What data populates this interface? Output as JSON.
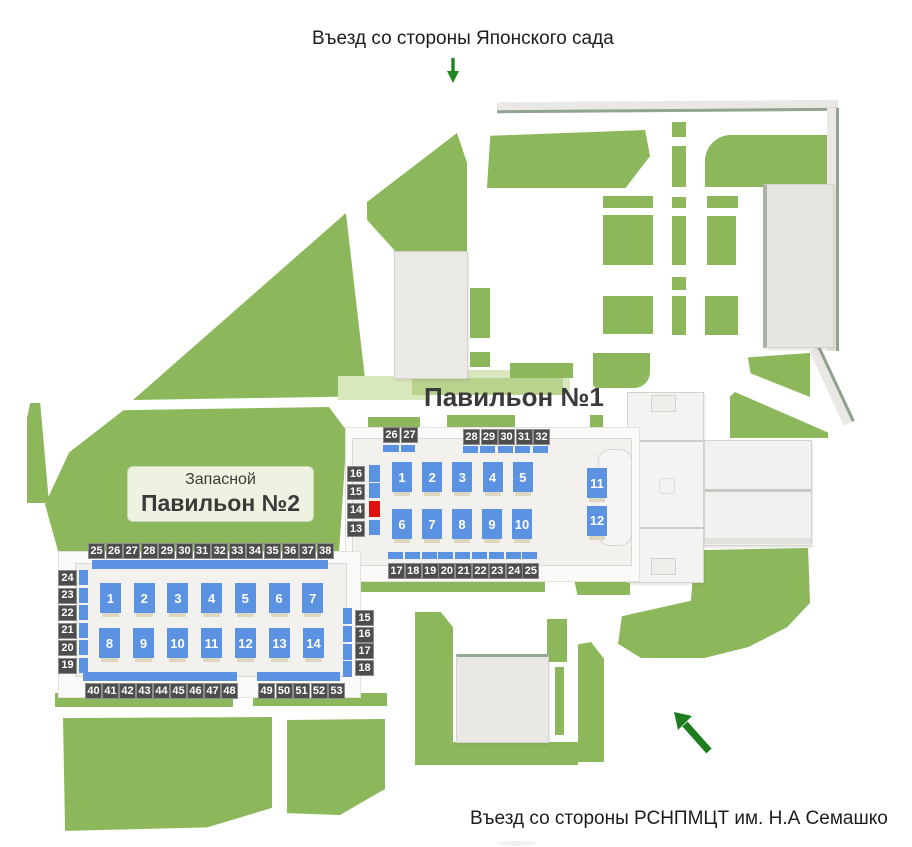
{
  "entrances": {
    "top": {
      "label": "Въезд со стороны Японского сада"
    },
    "bottom": {
      "label": "Въезд со стороны РСНПМЦТ им. Н.А Семашко"
    }
  },
  "pavilion1": {
    "title": "Павильон №1",
    "booths_row1": [
      "1",
      "2",
      "3",
      "4",
      "5"
    ],
    "booths_row2": [
      "6",
      "7",
      "8",
      "9",
      "10"
    ],
    "booths_right": [
      "11",
      "12"
    ],
    "top_badges_left": [
      "26",
      "27"
    ],
    "top_badges_right": [
      "28",
      "29",
      "30",
      "31",
      "32"
    ],
    "left_badges": [
      "16",
      "15",
      "14",
      "13"
    ],
    "bottom_badges": [
      "17",
      "18",
      "19",
      "20",
      "21",
      "22",
      "23",
      "24",
      "25"
    ],
    "occupied_spot": "14"
  },
  "pavilion2": {
    "title_line1": "Запасной",
    "title_line2": "Павильон №2",
    "booths_row1": [
      "1",
      "2",
      "3",
      "4",
      "5",
      "6",
      "7"
    ],
    "booths_row2": [
      "8",
      "9",
      "10",
      "11",
      "12",
      "13",
      "14"
    ],
    "top_badges": [
      "25",
      "26",
      "27",
      "28",
      "29",
      "30",
      "31",
      "32",
      "33",
      "34",
      "35",
      "36",
      "37",
      "38"
    ],
    "left_badges": [
      "24",
      "23",
      "22",
      "21",
      "20",
      "19"
    ],
    "right_badges": [
      "15",
      "16",
      "17",
      "18"
    ],
    "bottom_badges_left": [
      "40",
      "41",
      "42",
      "43",
      "44",
      "45",
      "46",
      "47",
      "48"
    ],
    "bottom_badges_right": [
      "49",
      "50",
      "51",
      "52",
      "53"
    ]
  },
  "colors": {
    "lawn_green": "#8cb75a",
    "booth_blue": "#5b92e2",
    "badge_dark": "#4d4d4d",
    "occupied_red": "#e01010",
    "arrow_green": "#1e8a1e"
  }
}
